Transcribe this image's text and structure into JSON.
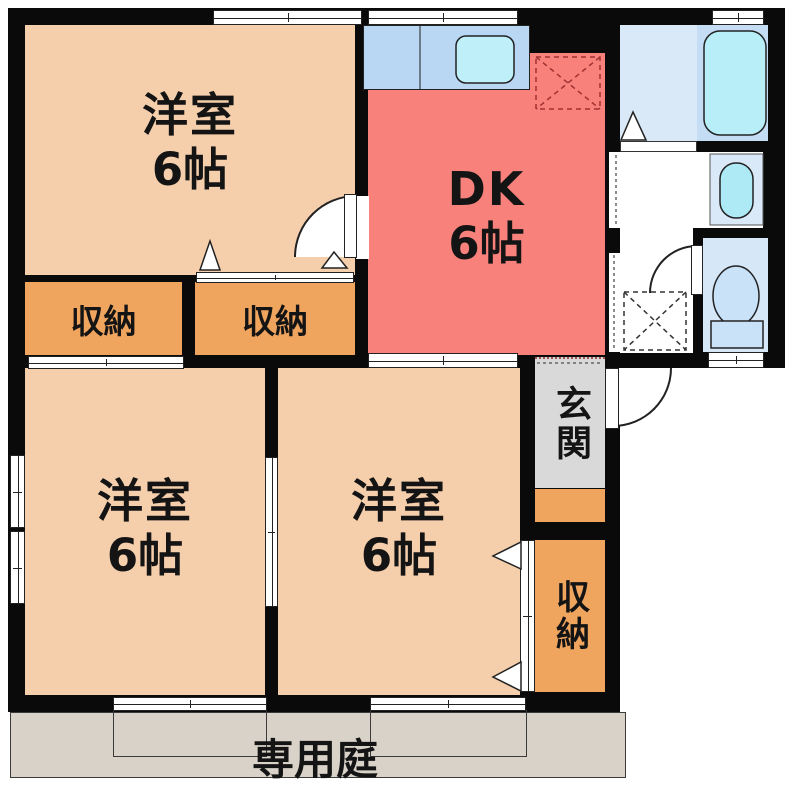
{
  "plan": {
    "type": "apartment-floor-plan",
    "rooms": {
      "bedroom1": {
        "label": "洋室",
        "size": "6帖"
      },
      "dk": {
        "label": "DK",
        "size": "6帖"
      },
      "bedroom2": {
        "label": "洋室",
        "size": "6帖"
      },
      "bedroom3": {
        "label": "洋室",
        "size": "6帖"
      },
      "closet1": {
        "label": "収納"
      },
      "closet2": {
        "label": "収納"
      },
      "closet3": {
        "label": "収納"
      },
      "entrance": {
        "label": "玄関"
      },
      "garden": {
        "label": "専用庭"
      }
    },
    "fixtures": [
      "bathtub",
      "kitchen-sink",
      "washbasin",
      "toilet",
      "refrigerator-space",
      "washing-machine-space"
    ],
    "colors": {
      "wall": "#0a0a0a",
      "bedroom": "#F5CEAB",
      "closet": "#F0A55F",
      "dk": "#F8817B",
      "entrance_floor": "#D9D9D9",
      "garden": "#D9D2C9",
      "bath_floor": "#D9E9F8",
      "tub_zone": "#C4DDF5",
      "fixture_cyan": "#B7EEF8",
      "kitchen_counter": "#B9D6F3",
      "toilet_room": "#D6E7F8",
      "toilet_fill": "#C9E2F8"
    }
  }
}
